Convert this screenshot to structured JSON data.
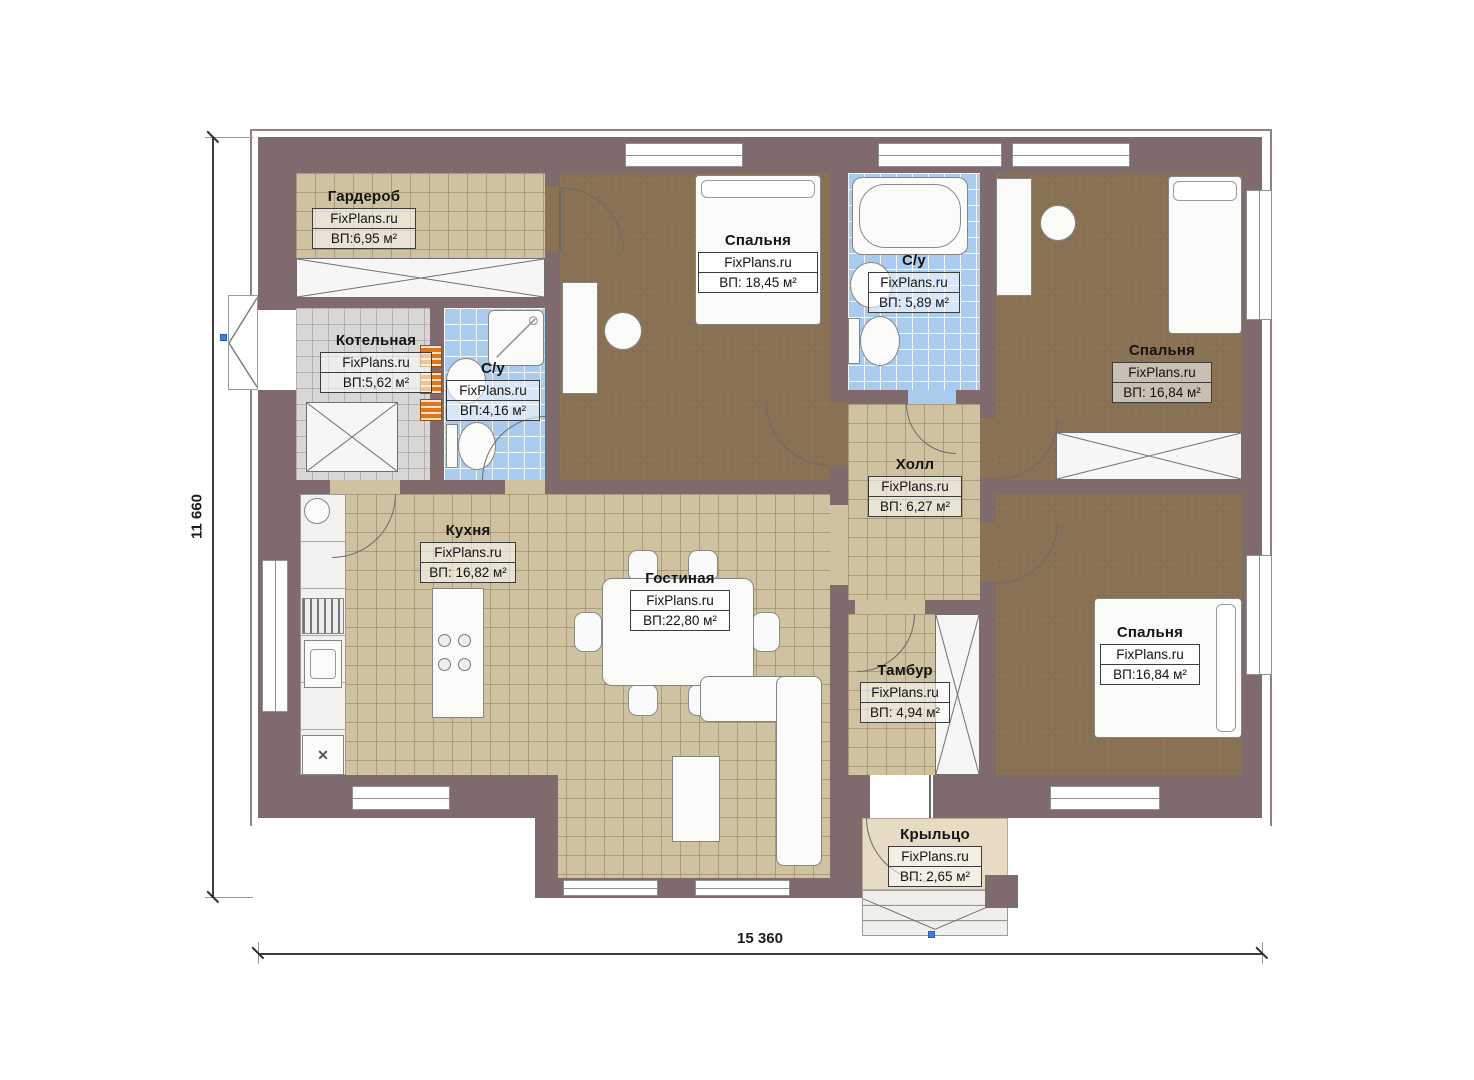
{
  "plan": {
    "brand": "FixPlans.ru",
    "type": "floor-plan"
  },
  "dimensions": {
    "height_label": "11 660",
    "width_label": "15 360"
  },
  "rooms": [
    {
      "id": "wardrobe",
      "name": "Гардероб",
      "brand": "FixPlans.ru",
      "area": "ВП:6,95 м²"
    },
    {
      "id": "boiler",
      "name": "Котельная",
      "brand": "FixPlans.ru",
      "area": "ВП:5,62 м²"
    },
    {
      "id": "bath1",
      "name": "С/у",
      "brand": "FixPlans.ru",
      "area": "ВП:4,16 м²"
    },
    {
      "id": "bedroom1",
      "name": "Спальня",
      "brand": "FixPlans.ru",
      "area": "ВП: 18,45 м²"
    },
    {
      "id": "bath2",
      "name": "С/у",
      "brand": "FixPlans.ru",
      "area": "ВП: 5,89 м²"
    },
    {
      "id": "bedroom2",
      "name": "Спальня",
      "brand": "FixPlans.ru",
      "area": "ВП: 16,84 м²"
    },
    {
      "id": "hall",
      "name": "Холл",
      "brand": "FixPlans.ru",
      "area": "ВП: 6,27 м²"
    },
    {
      "id": "kitchen",
      "name": "Кухня",
      "brand": "FixPlans.ru",
      "area": "ВП: 16,82 м²"
    },
    {
      "id": "living",
      "name": "Гостиная",
      "brand": "FixPlans.ru",
      "area": "ВП:22,80 м²"
    },
    {
      "id": "tambour",
      "name": "Тамбур",
      "brand": "FixPlans.ru",
      "area": "ВП: 4,94 м²"
    },
    {
      "id": "bedroom3",
      "name": "Спальня",
      "brand": "FixPlans.ru",
      "area": "ВП:16,84 м²"
    },
    {
      "id": "porch",
      "name": "Крыльцо",
      "brand": "FixPlans.ru",
      "area": "ВП: 2,65 м²"
    }
  ],
  "colors": {
    "wall": "#7f6b6d",
    "tile_tan": "#cfc2a1",
    "tile_blue": "#a9cbee",
    "tile_gray": "#d8d7d5",
    "carpet": "#8a7355",
    "porch": "#e7dbc6",
    "radiator_orange": "#e0761c",
    "grip_blue": "#3f7dd8"
  }
}
